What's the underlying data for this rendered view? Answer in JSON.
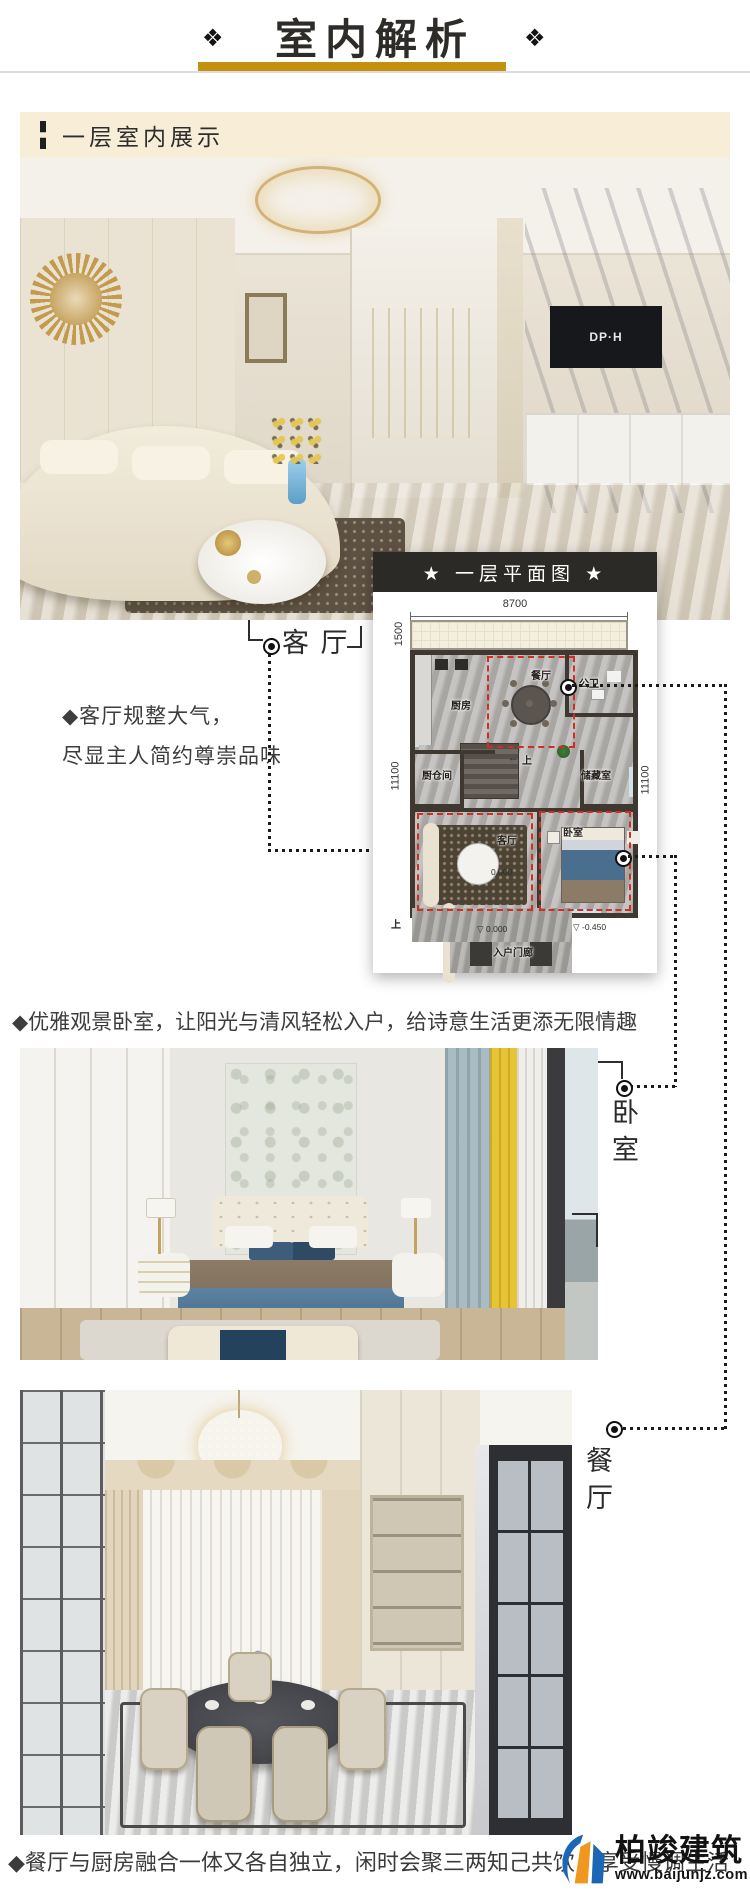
{
  "header": {
    "title": "室内解析",
    "ornament": "❖"
  },
  "section": {
    "label": "一层室内展示"
  },
  "living": {
    "tag": "客 厅",
    "desc_line1": "◆客厅规整大气，",
    "desc_line2": "尽显主人简约尊崇品味",
    "tv_logo": "DP·H"
  },
  "plan": {
    "title": "★ 一层平面图 ★",
    "dim_top": "8700",
    "dim_balcony": "1500",
    "dim_left": "11100",
    "dim_right": "11100",
    "rooms": {
      "kitchen": "厨房",
      "dining": "餐厅",
      "bath": "公卫",
      "pantry": "厨仓间",
      "storage": "储藏室",
      "living": "客厅",
      "bedroom": "卧室",
      "porch": "入户门廊"
    },
    "stairs_arrow": "←",
    "stairs_up": "上",
    "up_outside": "上",
    "level_marker": "▽",
    "level_living": "0.000",
    "level_porch": "0.000",
    "level_outside": "-0.450"
  },
  "bedroom": {
    "desc": "◆优雅观景卧室，让阳光与清风轻松入户，给诗意生活更添无限情趣",
    "tag": "卧室"
  },
  "dining": {
    "tag": "餐厅"
  },
  "footer": {
    "desc": "◆餐厅与厨房融合一体又各自独立，闲时会聚三两知己共饮，享受慢调生活"
  },
  "watermark": {
    "brand": "柏竣建筑",
    "site": "www.baijunjz.com"
  },
  "colors": {
    "gold": "#C3910E",
    "cream_bar": "#F8EDD6",
    "plan_bar": "#2B2A27",
    "red_dash": "#CF2F23",
    "wm_blue": "#1B66B5",
    "wm_orange": "#F0971F"
  }
}
